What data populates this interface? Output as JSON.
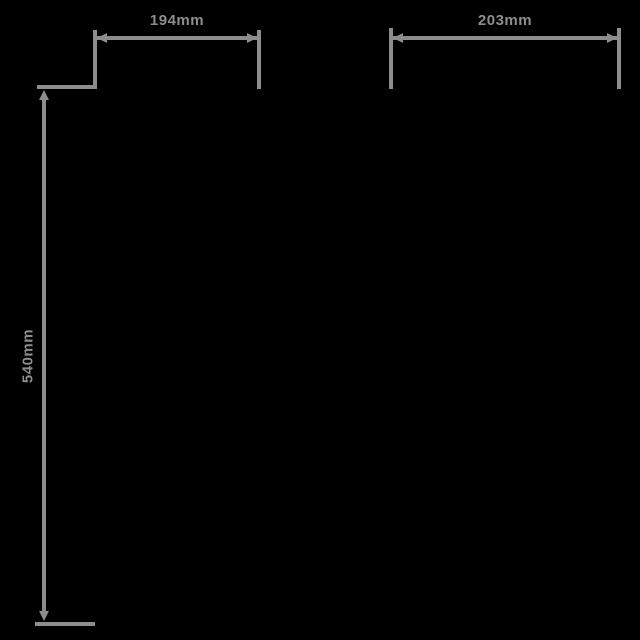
{
  "colors": {
    "background": "#000000",
    "line": "#8d8d8d"
  },
  "diagram": {
    "description": "product-dimension-drawing",
    "dimensions": {
      "top_left": {
        "label": "194mm",
        "orientation": "horizontal"
      },
      "top_right": {
        "label": "203mm",
        "orientation": "horizontal"
      },
      "left_vertical": {
        "label": "540mm",
        "orientation": "vertical"
      }
    }
  }
}
